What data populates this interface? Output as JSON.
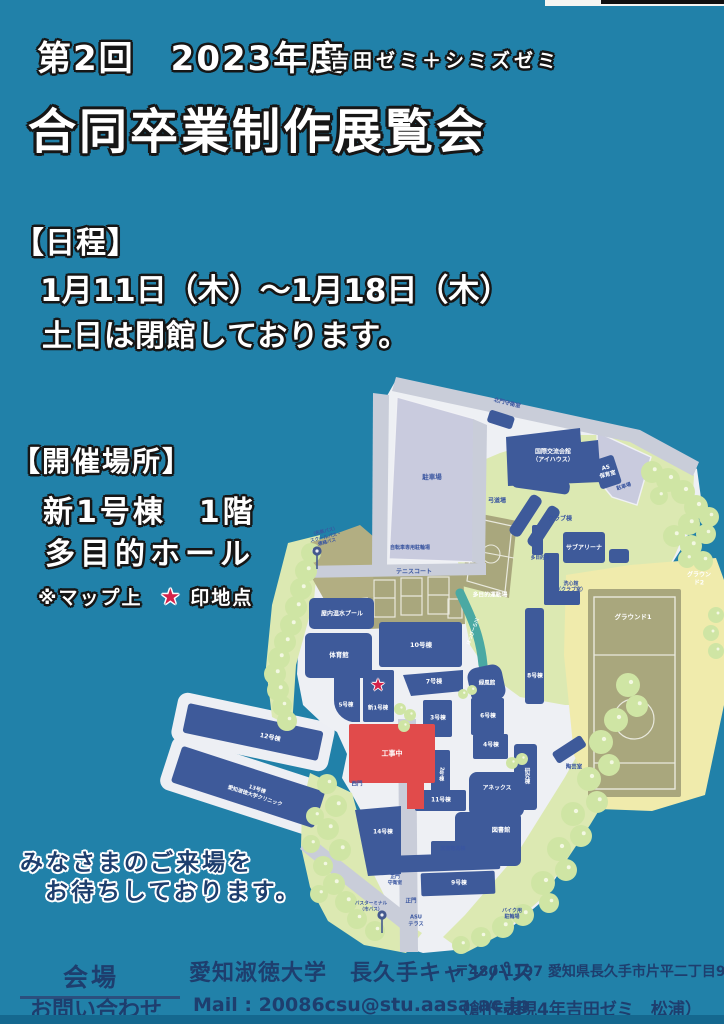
{
  "poster": {
    "header": {
      "edition_year": "第2回　2023年度",
      "seminars": "吉田ゼミ＋シミズゼミ",
      "title": "合同卒業制作展覧会"
    },
    "schedule": {
      "heading": "【日程】",
      "dates": "1月11日（木）～1月18日（木）",
      "note": "土日は閉館しております。"
    },
    "venue": {
      "heading": "【開催場所】",
      "building": "新1号棟　1階",
      "hall": "多目的ホール",
      "map_note_prefix": "※マップ上",
      "map_note_star": "★",
      "map_note_suffix": "印地点"
    },
    "closing": {
      "line1": "みなさまのご来場を",
      "line2": "お待ちしております。"
    },
    "footer": {
      "venue_label": "会場",
      "contact_label": "お問い合わせ",
      "university": "愛知淑徳大学　長久手キャンパス",
      "address": "〒480-1197 愛知県長久手市片平二丁目9",
      "mail": "Mail : 20086csu@stu.aasa.ac.jp",
      "credit": "（創作表現4年吉田ゼミ　松浦）"
    },
    "colors": {
      "background": "#2181a9",
      "building_blue": "#3e5a9a",
      "construction_red": "#e14b4b",
      "star_red": "#d4224a",
      "navy_text": "#1e3e6e"
    }
  },
  "map": {
    "star_marks": "新1号棟",
    "labels": [
      {
        "t": "北門守衛室",
        "x": 347,
        "y": 29,
        "s": 5.5,
        "c": "b",
        "r": 14
      },
      {
        "t": "駐車場",
        "x": 272,
        "y": 102,
        "s": 6.5,
        "c": "b"
      },
      {
        "t": "国際交流会館\n（アイハウス）",
        "x": 393,
        "y": 81,
        "s": 6,
        "c": "w"
      },
      {
        "t": "AS\n保育室",
        "x": 447,
        "y": 97,
        "s": 5.5,
        "c": "w",
        "r": -15
      },
      {
        "t": "駐車場",
        "x": 464,
        "y": 112,
        "s": 5,
        "c": "b",
        "r": -18
      },
      {
        "t": "自転車専用駐輪場",
        "x": 250,
        "y": 173,
        "s": 5,
        "c": "b"
      },
      {
        "t": "弓道場",
        "x": 337,
        "y": 126,
        "s": 6,
        "c": "b"
      },
      {
        "t": "クラブ棟",
        "x": 400,
        "y": 144,
        "s": 6,
        "c": "b"
      },
      {
        "t": "（名鉄バス）\nスクールバス・\n連絡バス",
        "x": 166,
        "y": 163,
        "s": 4.6,
        "c": "b",
        "r": -14
      },
      {
        "t": "サブアリーナ",
        "x": 424,
        "y": 173,
        "s": 6,
        "c": "w"
      },
      {
        "t": "多目的棟",
        "x": 380,
        "y": 184,
        "s": 4.6,
        "c": "b"
      },
      {
        "t": "多目的運動場",
        "x": 330,
        "y": 221,
        "s": 5.8,
        "c": "w"
      },
      {
        "t": "洗心館\n（クラブ室）",
        "x": 411,
        "y": 212,
        "s": 5,
        "c": "b"
      },
      {
        "t": "グラウンド2",
        "x": 539,
        "y": 204,
        "s": 6,
        "c": "w"
      },
      {
        "t": "グラウンド1",
        "x": 473,
        "y": 242,
        "s": 6.5,
        "c": "w"
      },
      {
        "t": "テニスコート",
        "x": 254,
        "y": 197,
        "s": 6,
        "c": "b"
      },
      {
        "t": "屋内温水プール",
        "x": 182,
        "y": 239,
        "s": 6,
        "c": "w"
      },
      {
        "t": "体育館",
        "x": 179,
        "y": 280,
        "s": 6.5,
        "c": "w"
      },
      {
        "t": "10号棟",
        "x": 261,
        "y": 270,
        "s": 6.5,
        "c": "w"
      },
      {
        "t": "ほっぴーら川",
        "x": 314,
        "y": 257,
        "s": 4.6,
        "c": "w",
        "r": -70
      },
      {
        "t": "8号棟",
        "x": 375,
        "y": 302,
        "s": 5.8,
        "c": "w"
      },
      {
        "t": "緑風館",
        "x": 327,
        "y": 309,
        "s": 5.5,
        "c": "w"
      },
      {
        "t": "7号棟",
        "x": 274,
        "y": 307,
        "s": 6,
        "c": "w"
      },
      {
        "t": "5号棟",
        "x": 186,
        "y": 331,
        "s": 5.5,
        "c": "w"
      },
      {
        "t": "新1号棟",
        "x": 218,
        "y": 334,
        "s": 5.5,
        "c": "w"
      },
      {
        "t": "★",
        "x": 218,
        "y": 311,
        "s": 17,
        "c": "star"
      },
      {
        "t": "3号棟",
        "x": 278,
        "y": 344,
        "s": 5.8,
        "c": "w"
      },
      {
        "t": "6号棟",
        "x": 328,
        "y": 342,
        "s": 5.8,
        "c": "w"
      },
      {
        "t": "4号棟",
        "x": 331,
        "y": 371,
        "s": 5.8,
        "c": "w"
      },
      {
        "t": "工事中",
        "x": 232,
        "y": 379,
        "s": 7,
        "c": "w"
      },
      {
        "t": "西門",
        "x": 197,
        "y": 410,
        "s": 5.5,
        "c": "b"
      },
      {
        "t": "2号棟",
        "x": 281,
        "y": 399,
        "s": 5.2,
        "c": "w",
        "v": true
      },
      {
        "t": "研究棟",
        "x": 366,
        "y": 401,
        "s": 5.5,
        "c": "w",
        "v": true
      },
      {
        "t": "陶芸室",
        "x": 414,
        "y": 393,
        "s": 5.5,
        "c": "b"
      },
      {
        "t": "アネックス",
        "x": 337,
        "y": 414,
        "s": 5.8,
        "c": "w"
      },
      {
        "t": "11号棟",
        "x": 281,
        "y": 426,
        "s": 5.8,
        "c": "w"
      },
      {
        "t": "図書館",
        "x": 341,
        "y": 456,
        "s": 6.2,
        "c": "w"
      },
      {
        "t": "12号棟",
        "x": 110,
        "y": 363,
        "s": 6.2,
        "c": "w",
        "r": 12
      },
      {
        "t": "13号棟\n愛知淑徳大学クリニック",
        "x": 96,
        "y": 418,
        "s": 5.2,
        "c": "w",
        "r": 18
      },
      {
        "t": "図書館南棟",
        "x": 293,
        "y": 474,
        "s": 5,
        "c": "b"
      },
      {
        "t": "14号棟",
        "x": 223,
        "y": 458,
        "s": 5.8,
        "c": "w"
      },
      {
        "t": "9号棟",
        "x": 299,
        "y": 509,
        "s": 5.8,
        "c": "w"
      },
      {
        "t": "正門\n守衛室",
        "x": 235,
        "y": 506,
        "s": 4.8,
        "c": "b"
      },
      {
        "t": "正門",
        "x": 251,
        "y": 527,
        "s": 5.5,
        "c": "b"
      },
      {
        "t": "バスターミナル\n（市バス）",
        "x": 211,
        "y": 532,
        "s": 4.6,
        "c": "b"
      },
      {
        "t": "ASU\nテラス",
        "x": 256,
        "y": 546,
        "s": 5.2,
        "c": "b"
      },
      {
        "t": "バイク用\n駐輪場",
        "x": 352,
        "y": 539,
        "s": 5,
        "c": "b"
      }
    ]
  }
}
